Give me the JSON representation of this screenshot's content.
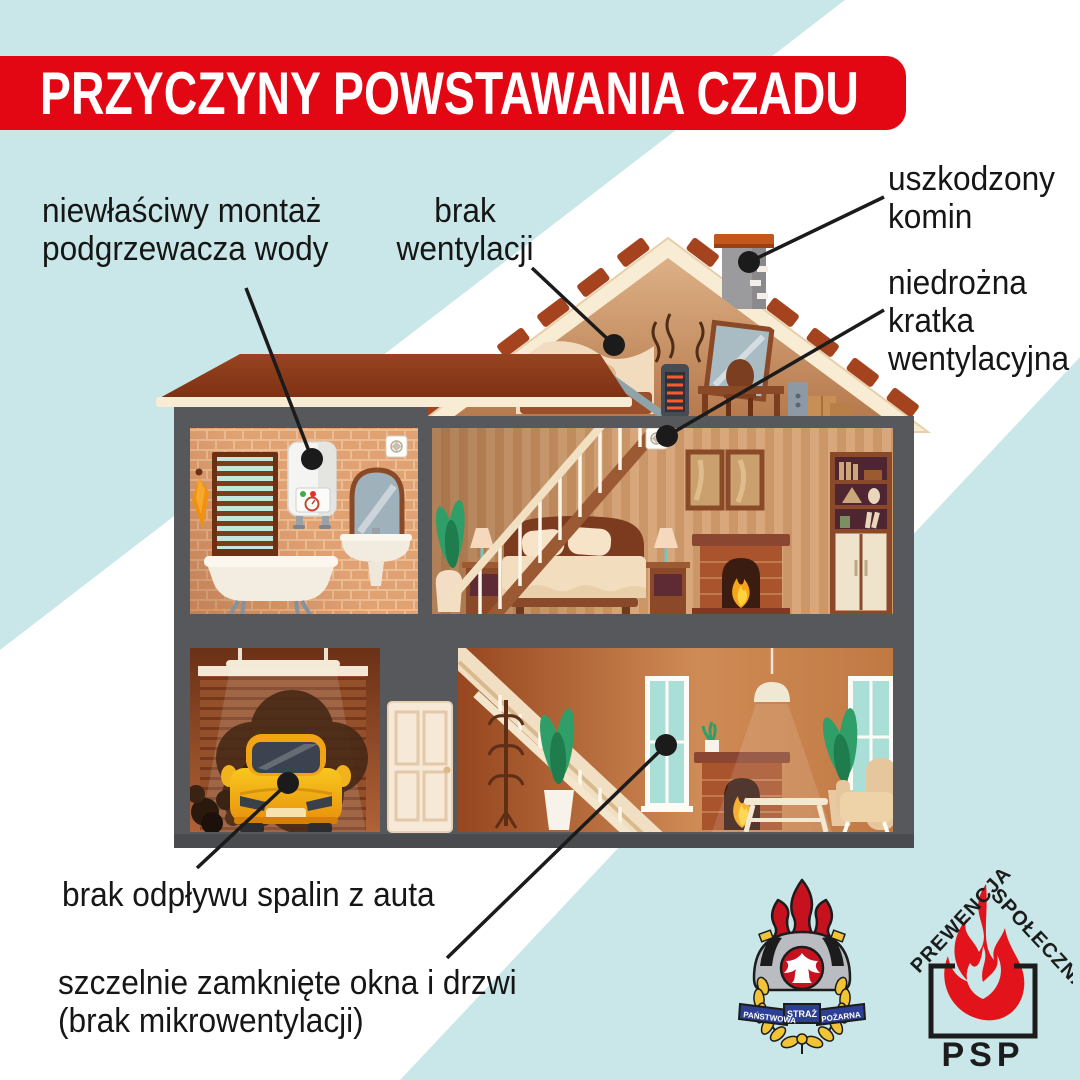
{
  "title": "PRZYCZYNY POWSTAWANIA CZADU",
  "labels": {
    "water_heater": {
      "line1": "niewłaściwy montaż",
      "line2": "podgrzewacza wody"
    },
    "no_ventilation": {
      "line1": "brak",
      "line2": "wentylacji"
    },
    "damaged_chimney": {
      "line1": "uszkodzony",
      "line2": "komin"
    },
    "blocked_grille": {
      "line1": "niedrożna",
      "line2": "kratka",
      "line3": "wentylacyjna"
    },
    "car_exhaust": {
      "line1": "brak odpływu spalin z auta"
    },
    "closed_windows": {
      "line1": "szczelnie zamknięte okna i drzwi",
      "line2": "(brak mikrowentylacji)"
    }
  },
  "logos": {
    "crest": {
      "ribbon_left": "PAŃSTWOWA",
      "ribbon_center": "STRAŻ",
      "ribbon_right": "POŻARNA"
    },
    "prevention": {
      "roof_left": "PREWENCJA",
      "roof_right": "SPOŁECZNA",
      "name": "PSP"
    }
  },
  "colors": {
    "background_blue": "#c9e7e8",
    "banner_red": "#e30613",
    "label_text": "#161616",
    "leader_line": "#1b1b1b",
    "crest_red": "#c6121f",
    "crest_blue": "#2d3f92",
    "crest_yellow": "#f0c436",
    "prevention_red": "#e2131b"
  }
}
